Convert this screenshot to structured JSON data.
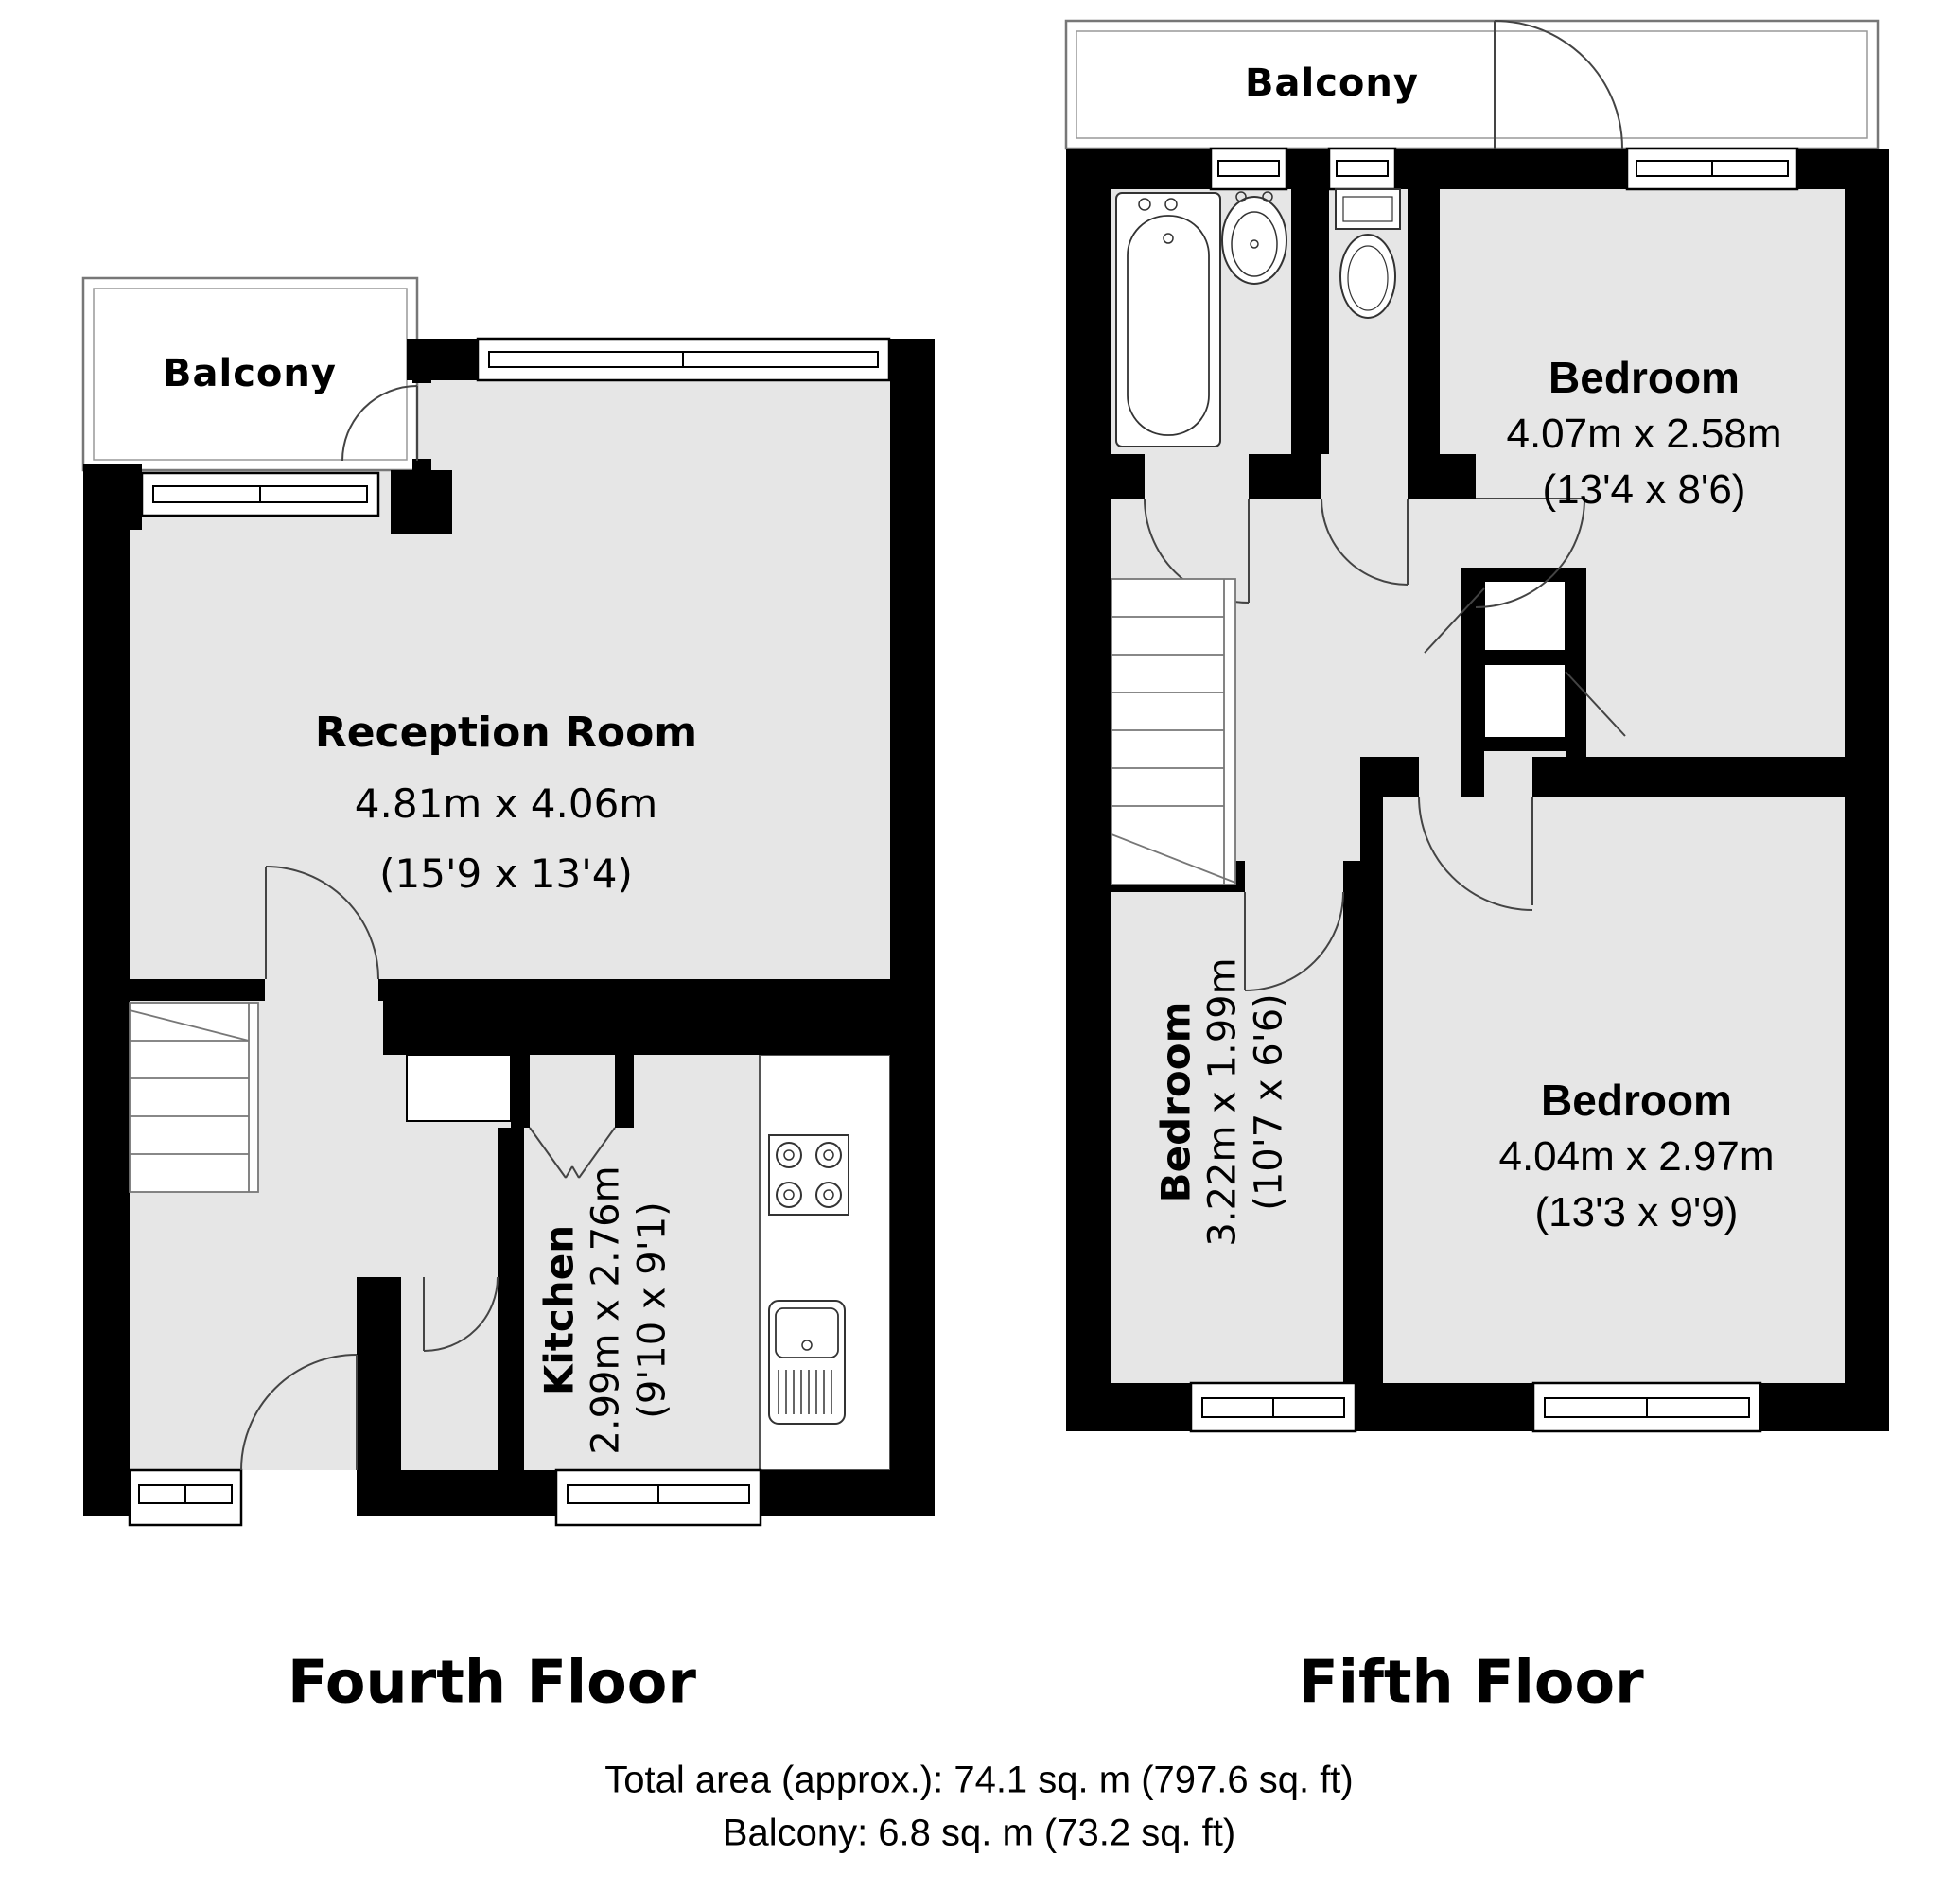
{
  "document": {
    "type": "floorplan"
  },
  "colors": {
    "wall": "#000000",
    "floor_fill": "#e6e6e6",
    "balcony_outline": "#777777",
    "fixture_line": "#333333",
    "background": "#ffffff"
  },
  "floors": [
    {
      "title": "Fourth Floor",
      "rooms": [
        {
          "label": "Balcony"
        },
        {
          "label": "Reception Room",
          "dims_metric": "4.81m x 4.06m",
          "dims_imperial": "(15'9 x 13'4)"
        },
        {
          "label": "Kitchen",
          "dims_metric": "2.99m x 2.76m",
          "dims_imperial": "(9'10 x 9'1)"
        }
      ],
      "fixtures": [
        "stairs",
        "hob",
        "kitchen-sink-drainer",
        "entrance-door",
        "balcony-door",
        "fold-door",
        "cupboard",
        "windows"
      ]
    },
    {
      "title": "Fifth Floor",
      "rooms": [
        {
          "label": "Balcony"
        },
        {
          "label": "Bedroom",
          "dims_metric": "4.07m x 2.58m",
          "dims_imperial": "(13'4 x 8'6)"
        },
        {
          "label": "Bedroom",
          "dims_metric": "4.04m x 2.97m",
          "dims_imperial": "(13'3 x 9'9)"
        },
        {
          "label": "Bedroom",
          "dims_metric": "3.22m x 1.99m",
          "dims_imperial": "(10'7 x 6'6)"
        }
      ],
      "fixtures": [
        "stairs",
        "bath-tub",
        "wash-basin",
        "toilet",
        "cupboards",
        "windows",
        "balcony-door"
      ]
    }
  ],
  "footer": {
    "total_area": "Total area (approx.): 74.1 sq. m (797.6 sq. ft)",
    "balcony_area": "Balcony: 6.8 sq. m (73.2 sq. ft)"
  }
}
